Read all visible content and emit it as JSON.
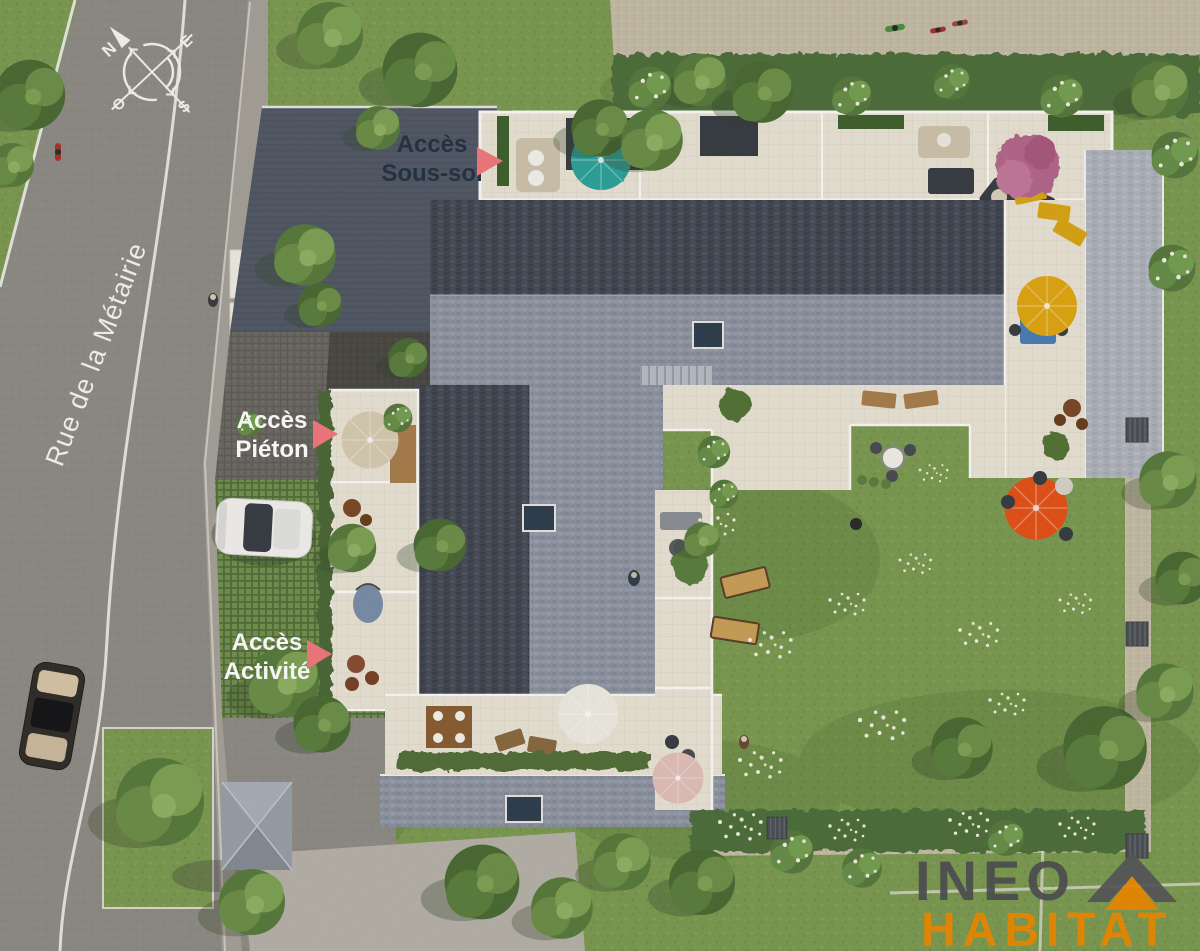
{
  "scene": {
    "description": "Aerial 3D architectural site plan of a residential programme",
    "street": {
      "name": "Rue de la Métairie"
    },
    "compass": {
      "north": "N",
      "east": "E",
      "south": "S",
      "west": "O"
    },
    "access_points": {
      "sous_sol": {
        "line1": "Accès",
        "line2": "Sous-sol"
      },
      "pieton": {
        "line1": "Accès",
        "line2": "Piéton"
      },
      "activite": {
        "line1": "Accès",
        "line2": "Activité"
      }
    },
    "branding": {
      "company_line1": "INEO",
      "company_line2": "HABITAT"
    },
    "colors": {
      "label_dark": "#263445",
      "label_light": "#ffffff",
      "arrow_pink": "#f2797e",
      "logo_gray": "#4f5052",
      "logo_orange": "#f08a00",
      "roof_dark": "#474c56",
      "roof_light": "#9096a2",
      "terrace_cream": "#eae4d6",
      "lawn_green": "#7d9b53",
      "asphalt_gray": "#8f8c86",
      "umbrella_teal": "#2ea39b",
      "umbrella_yellow": "#e0a714",
      "umbrella_orange": "#e45319"
    }
  }
}
